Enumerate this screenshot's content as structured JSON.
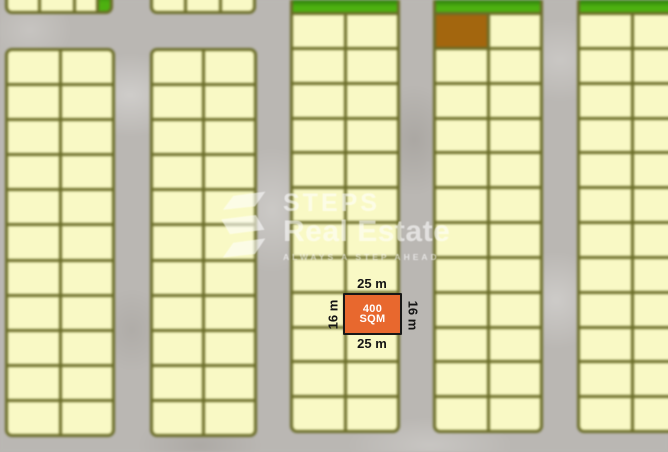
{
  "map": {
    "palette": {
      "road": "#bab7b3",
      "plot_fill": "#f9f9c5",
      "plot_border": "#6a6c28",
      "green_zone": "#4db110",
      "green_zone_dark": "#2c7a0c",
      "brown_plot": "#a3660e",
      "highlight_fill": "#e8682e",
      "highlight_border": "#171717",
      "dimension_text": "#141414"
    },
    "blocks": [
      {
        "id": "block-1-top-partial",
        "x": 5,
        "y": -9,
        "w": 108,
        "h": 23,
        "rows": 1,
        "cols": 4,
        "tracks": [
          35,
          37,
          23,
          13
        ],
        "cut_top": true,
        "specials": [
          {
            "r": 0,
            "c": 3,
            "type": "green"
          }
        ]
      },
      {
        "id": "block-2-top-partial",
        "x": 150,
        "y": -9,
        "w": 106,
        "h": 23,
        "rows": 1,
        "cols": 3,
        "cut_top": true
      },
      {
        "id": "block-1",
        "x": 5,
        "y": 48,
        "w": 110,
        "h": 389,
        "rows": 11,
        "cols": 2
      },
      {
        "id": "block-2",
        "x": 150,
        "y": 48,
        "w": 107,
        "h": 389,
        "rows": 11,
        "cols": 2
      },
      {
        "id": "block-3",
        "x": 290,
        "y": 0,
        "w": 110,
        "h": 433,
        "rows": 12,
        "cols": 2,
        "green_top": true,
        "cut_top": true
      },
      {
        "id": "block-4",
        "x": 433,
        "y": 0,
        "w": 110,
        "h": 433,
        "rows": 12,
        "cols": 2,
        "green_top": true,
        "cut_top": true,
        "specials": [
          {
            "r": 0,
            "c": 0,
            "type": "brown"
          }
        ]
      },
      {
        "id": "block-5",
        "x": 577,
        "y": 0,
        "w": 111,
        "h": 433,
        "rows": 12,
        "cols": 2,
        "green_top": true,
        "cut_top": true
      }
    ]
  },
  "highlight": {
    "area_line1": "400",
    "area_line2": "SQM",
    "width_top": "25 m",
    "width_bottom": "25 m",
    "height_left": "16 m",
    "height_right": "16 m"
  },
  "watermark": {
    "brand_top": "STEPS",
    "brand_bottom": "Real Estate",
    "tagline": "ALWAYS A STEP AHEAD",
    "color": "#ffffff"
  }
}
